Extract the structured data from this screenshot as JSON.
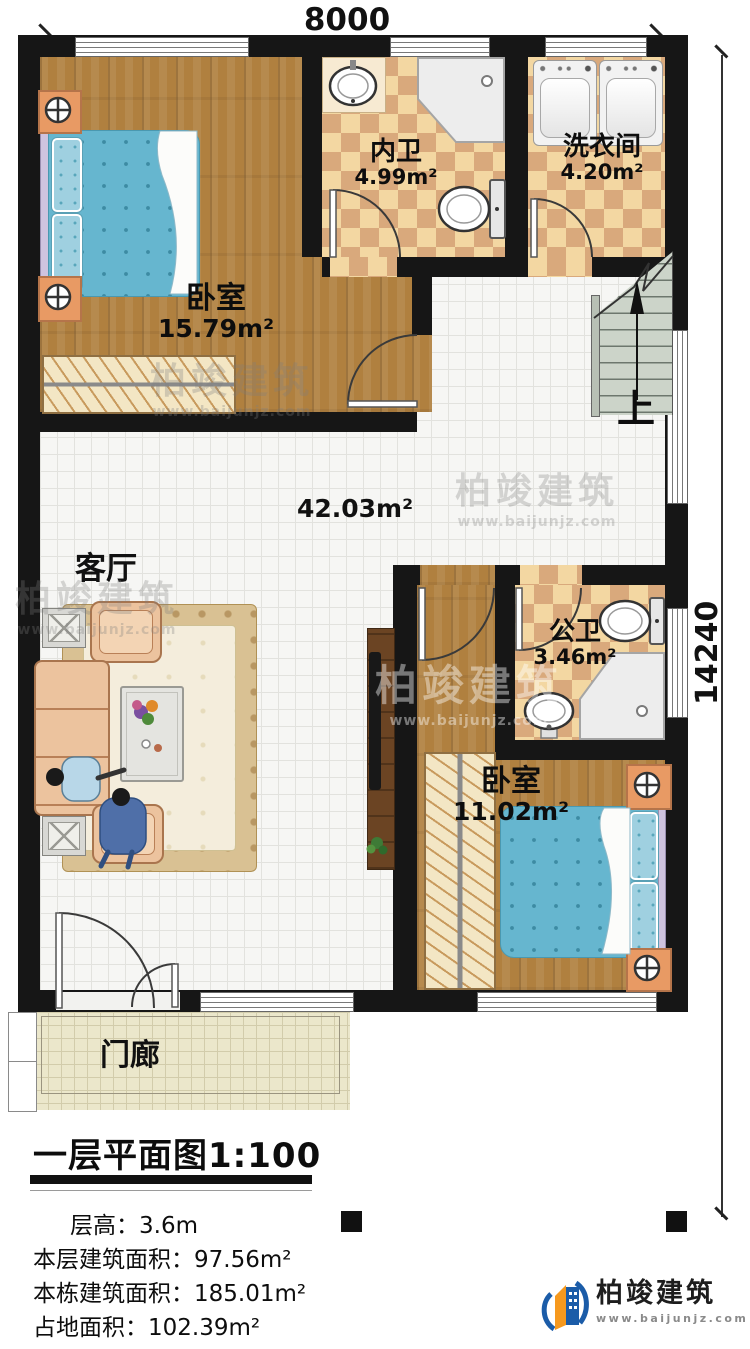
{
  "dimensions": {
    "width": "8000",
    "height": "14240"
  },
  "rooms": {
    "bedroom1": {
      "name": "卧室",
      "area": "15.79m²"
    },
    "ensuite": {
      "name": "内卫",
      "area": "4.99m²"
    },
    "laundry": {
      "name": "洗衣间",
      "area": "4.20m²"
    },
    "living": {
      "name": "客厅",
      "area": "42.03m²"
    },
    "bath": {
      "name": "公卫",
      "area": "3.46m²"
    },
    "bedroom2": {
      "name": "卧室",
      "area": "11.02m²"
    },
    "porch": {
      "name": "门廊"
    }
  },
  "stairs": {
    "up_label": "上"
  },
  "title": {
    "text": "一层平面图",
    "scale": "1:100"
  },
  "stats": {
    "rows": [
      {
        "label": "层高：",
        "value": "3.6m"
      },
      {
        "label": "本层建筑面积：",
        "value": "97.56m²"
      },
      {
        "label": "本栋建筑面积：",
        "value": "185.01m²"
      },
      {
        "label": "占地面积：",
        "value": "102.39m²"
      }
    ]
  },
  "watermark": {
    "name": "柏竣建筑",
    "url": "www.baijunjz.com"
  },
  "logo": {
    "name": "柏竣建筑",
    "url": "www.baijunjz.com"
  },
  "colors": {
    "wall": "#161616",
    "wood": "#b0803f",
    "checker_light": "#f3d7a2",
    "checker_dark": "#d9a97c",
    "tile": "#f6f6f4",
    "bed_blue": "#66b6cf",
    "sofa_peach": "#ecc39e",
    "stairs_green": "#ccd4c9",
    "porch_beige": "#ebe7cb",
    "logo_blue": "#1b5ca8",
    "logo_orange": "#f6991e"
  }
}
